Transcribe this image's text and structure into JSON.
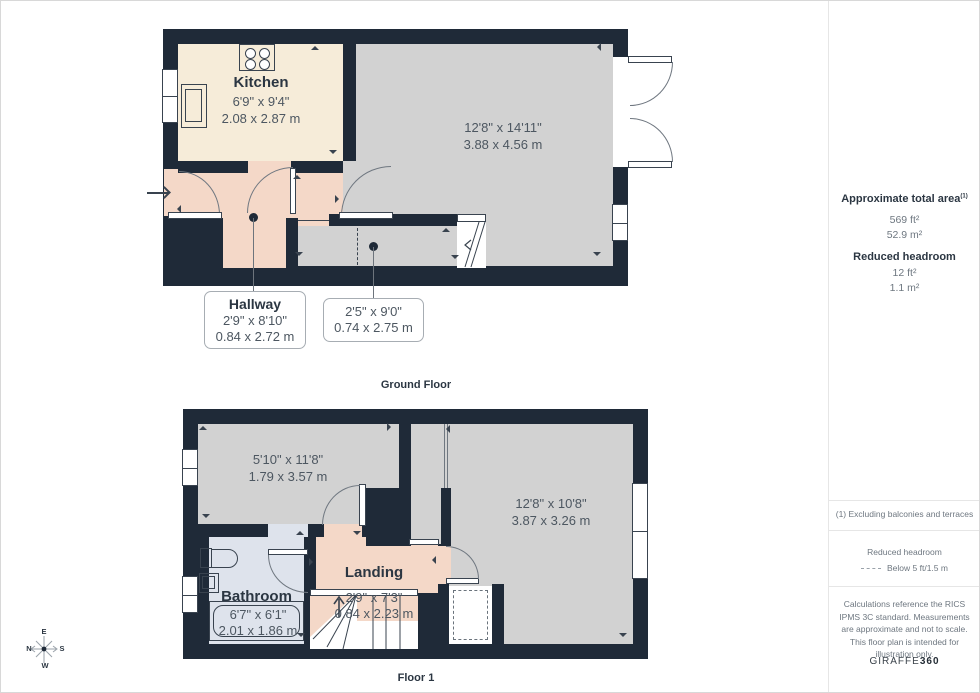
{
  "ground_floor": {
    "title": "Ground Floor",
    "kitchen": {
      "name": "Kitchen",
      "imperial": "6'9\" x 9'4\"",
      "metric": "2.08 x 2.87 m"
    },
    "living": {
      "imperial": "12'8\" x 14'11\"",
      "metric": "3.88 x 4.56 m"
    },
    "hallway": {
      "name": "Hallway",
      "imperial": "2'9\" x 8'10\"",
      "metric": "0.84 x 2.72 m"
    },
    "corridor": {
      "imperial": "2'5\" x 9'0\"",
      "metric": "0.74 x 2.75 m"
    }
  },
  "floor1": {
    "title": "Floor 1",
    "bedroom1": {
      "imperial": "5'10\" x 11'8\"",
      "metric": "1.79 x 3.57 m"
    },
    "bedroom2": {
      "imperial": "12'8\" x 10'8\"",
      "metric": "3.87 x 3.26 m"
    },
    "bathroom": {
      "name": "Bathroom",
      "imperial": "6'7\" x 6'1\"",
      "metric": "2.01 x 1.86 m"
    },
    "landing": {
      "name": "Landing",
      "imperial": "2'9\" x 7'3\"",
      "metric": "0.84 x 2.23 m"
    }
  },
  "sidebar": {
    "area_label": "Approximate total area",
    "area_sup": "(1)",
    "area_ft": "569 ft²",
    "area_m": "52.9 m²",
    "rh_label": "Reduced headroom",
    "rh_ft": "12 ft²",
    "rh_m": "1.1 m²",
    "footnote": "(1) Excluding balconies and terraces",
    "legend_title": "Reduced headroom",
    "legend_value": "Below 5 ft/1.5 m",
    "disclaimer": "Calculations reference the RICS IPMS 3C standard. Measurements are approximate and not to scale. This floor plan is intended for illustration only.",
    "brand": "GIRAFFE",
    "brand_bold": "360"
  },
  "compass": {
    "top": "E",
    "right": "S",
    "bottom": "W",
    "left": "N"
  },
  "colors": {
    "wall": "#1f2a38",
    "gray": "#d2d2d2",
    "cream": "#f6ecd9",
    "pink": "#f4d8c8",
    "blue": "#dee3ec",
    "ink": "#2b3642",
    "dim": "#4d5761",
    "line": "#39434f",
    "arc": "#6f7780",
    "leader": "#6d747c",
    "pageborder": "#d8d8d8",
    "divider": "#e6e6e6",
    "muted": "#6e7780"
  }
}
